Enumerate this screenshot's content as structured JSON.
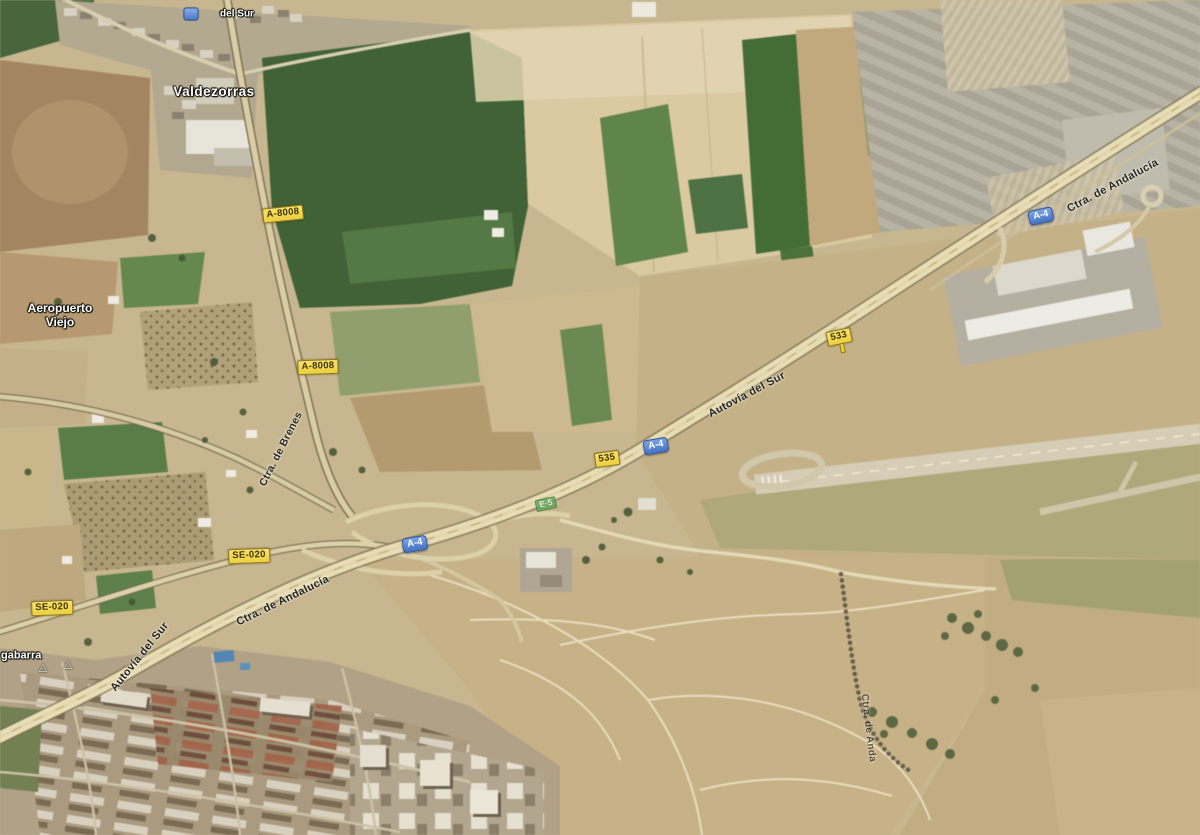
{
  "map": {
    "colors": {
      "badge_yellow_bg": "#f2d94f",
      "badge_yellow_text": "#41340a",
      "badge_blue_bg": "#4d7fcd",
      "badge_blue_text": "#ffffff",
      "badge_green_bg": "#5aa257",
      "place_label": "#ffffff",
      "road_label": "#26261f",
      "terrain_base": "#c8b68c"
    },
    "labels": {
      "valdezorras": "Valdezorras",
      "del_sur": "del Sur",
      "aeropuerto_1": "Aeropuerto",
      "aeropuerto_2": "Viejo",
      "gabarra": "gabarra",
      "ctra_andalucia_ne": "Ctra. de Andalucía",
      "ctra_andalucia_sw": "Ctra. de Andalucía",
      "autovia_del_sur_a": "Autovía del Sur",
      "autovia_del_sur_b": "Autovía del Sur",
      "ctra_de_brenes": "Ctra. de Brenes",
      "vereda": "Ctra. de Anda"
    },
    "badges": {
      "a8008_n": "A-8008",
      "a8008_s": "A-8008",
      "a4_ne": "A-4",
      "a4_mid": "A-4",
      "a4_sw": "A-4",
      "km_533": "533",
      "km_535": "535",
      "e5": "E-5",
      "se020_e": "SE-020",
      "se020_w": "SE-020"
    },
    "icons": {
      "warning_triangle_1": "△",
      "warning_triangle_2": "△"
    }
  }
}
